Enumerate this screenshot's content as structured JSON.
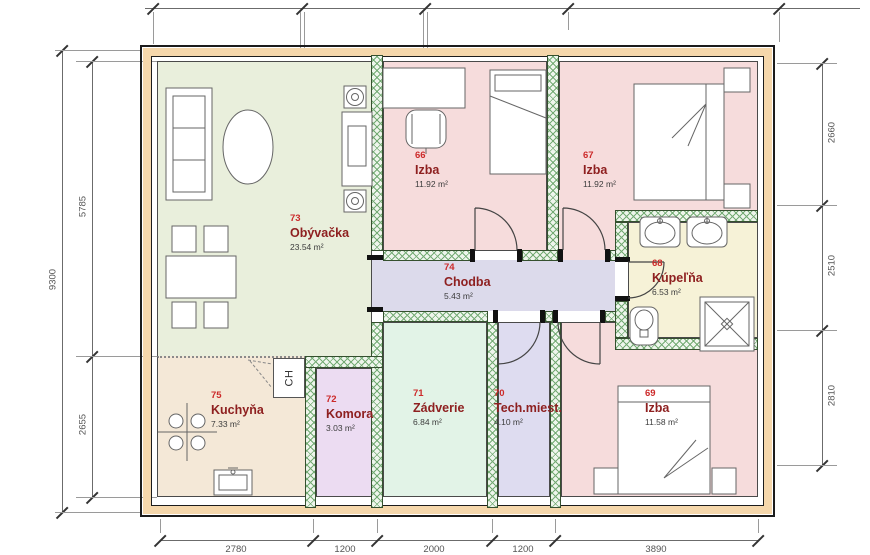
{
  "rooms": [
    {
      "number": "73",
      "name": "Obývačka",
      "area": "23.54 m²"
    },
    {
      "number": "66",
      "name": "Izba",
      "area": "11.92 m²"
    },
    {
      "number": "67",
      "name": "Izba",
      "area": "11.92 m²"
    },
    {
      "number": "74",
      "name": "Chodba",
      "area": "5.43 m²"
    },
    {
      "number": "68",
      "name": "Kúpeľňa",
      "area": "6.53 m²"
    },
    {
      "number": "75",
      "name": "Kuchyňa",
      "area": "7.33 m²"
    },
    {
      "number": "72",
      "name": "Komora",
      "area": "3.03 m²"
    },
    {
      "number": "71",
      "name": "Zádverie",
      "area": "6.84 m²"
    },
    {
      "number": "70",
      "name": "Tech.miest.",
      "area": "4.10 m²"
    },
    {
      "number": "69",
      "name": "Izba",
      "area": "11.58 m²"
    }
  ],
  "fixtures": {
    "fridge_label": "CH"
  },
  "dimensions": {
    "left": {
      "total": "9300",
      "upper": "5785",
      "lower": "2655"
    },
    "right": {
      "top": "2660",
      "middle": "2510",
      "bottom": "2810"
    },
    "bottom": [
      "2780",
      "1200",
      "2000",
      "1200",
      "3890"
    ]
  },
  "colors": {
    "exterior_wall": "#f5d7ab",
    "living": "#e9efdc",
    "bedroom": "#f6dcdc",
    "hall": "#dcdaeb",
    "bathroom": "#f6f2d7",
    "kitchen": "#f4e8d7",
    "pantry": "#ecdcf2",
    "entry": "#e2f3e7",
    "tech_room": "#dedcf0",
    "room_number": "#cc2a2a",
    "room_name": "#8e2020",
    "wall_hatch": "#74ab74"
  }
}
